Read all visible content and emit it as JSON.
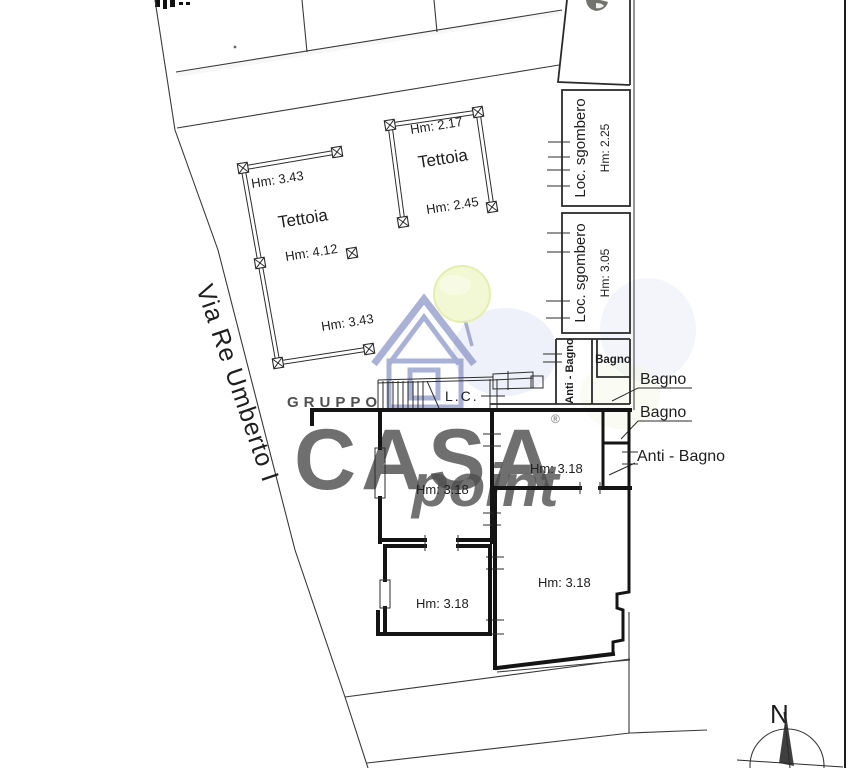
{
  "plan": {
    "street_name": "Via Re Umberto I",
    "stairwell_label": "L.C.",
    "compass_label": "N",
    "tettoia_large": {
      "name": "Tettoia",
      "height_top": "Hm: 3.43",
      "height_mid": "Hm: 4.12",
      "height_bottom": "Hm: 3.43"
    },
    "tettoia_small": {
      "name": "Tettoia",
      "height_top": "Hm: 2.17",
      "height_bottom": "Hm: 2.45"
    },
    "storage_room_1": {
      "name": "Loc. sgombero",
      "height": "Hm: 2.25"
    },
    "storage_room_2": {
      "name": "Loc. sgombero",
      "height": "Hm: 3.05"
    },
    "bath_block": {
      "anti_bagno_label": "Anti - Bagno",
      "bagno_label": "Bagno"
    },
    "callouts": {
      "bagno_upper": "Bagno",
      "bagno_lower": "Bagno",
      "anti_bagno": "Anti - Bagno"
    },
    "room_heights": {
      "room_a": "Hm: 3.18",
      "room_b": "Hm: 3.18",
      "room_c": "Hm: 3.18",
      "room_d": "Hm: 3.18"
    }
  },
  "watermark": {
    "group_label": "GRUPPO",
    "brand": "CASA",
    "brand_suffix": "point",
    "registered_mark": "®",
    "colors": {
      "brand_blue": "#4f5dab",
      "point_green": "#c3d84b",
      "group_gray": "#c9c9ce",
      "leaf_fill": "#eef5c2",
      "leaf_edge": "#dbe88e"
    }
  }
}
